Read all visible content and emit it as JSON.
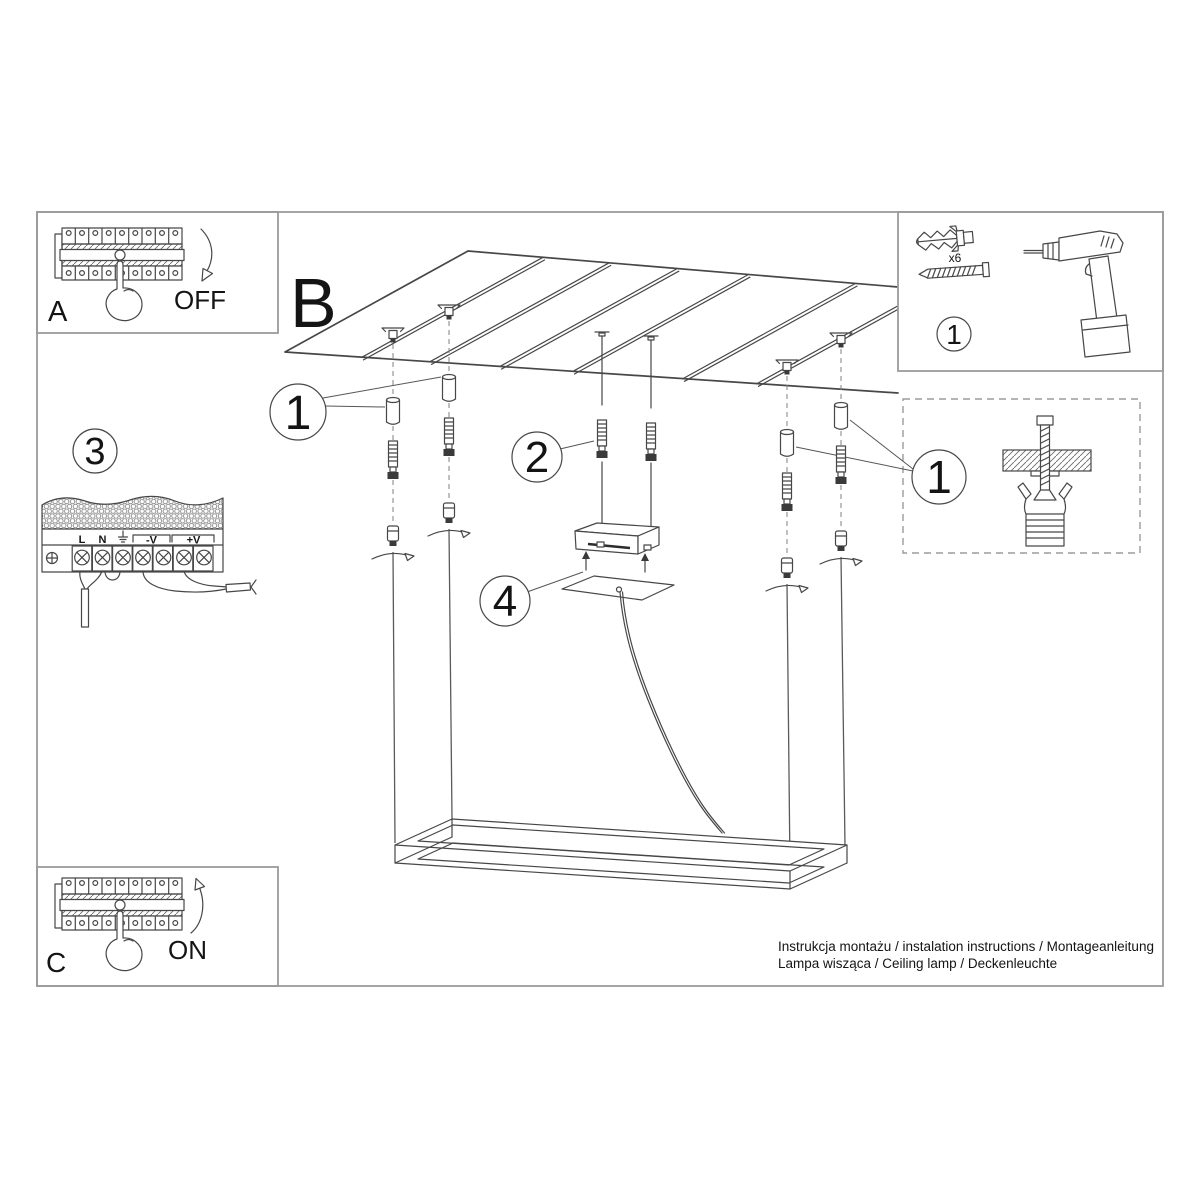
{
  "sheet": {
    "instructions_line1": "Instrukcja montażu / instalation instructions / Montageanleitung",
    "instructions_line2": "Lampa wisząca / Ceiling lamp / Deckenleuchte"
  },
  "labels": {
    "step_a": "A",
    "step_b": "B",
    "step_c": "C",
    "off": "OFF",
    "on": "ON",
    "callout_1": "1",
    "callout_2": "2",
    "callout_3": "3",
    "callout_4": "4",
    "anchor_count": "x6"
  },
  "terminal_block": {
    "labels": {
      "live": "L",
      "neutral": "N",
      "ground_icon": "earth-ground",
      "v_minus": "-V",
      "v_plus": "+V"
    }
  },
  "colors": {
    "line": "#474747",
    "frame_border": "#9b9b9b",
    "text": "#141414"
  }
}
